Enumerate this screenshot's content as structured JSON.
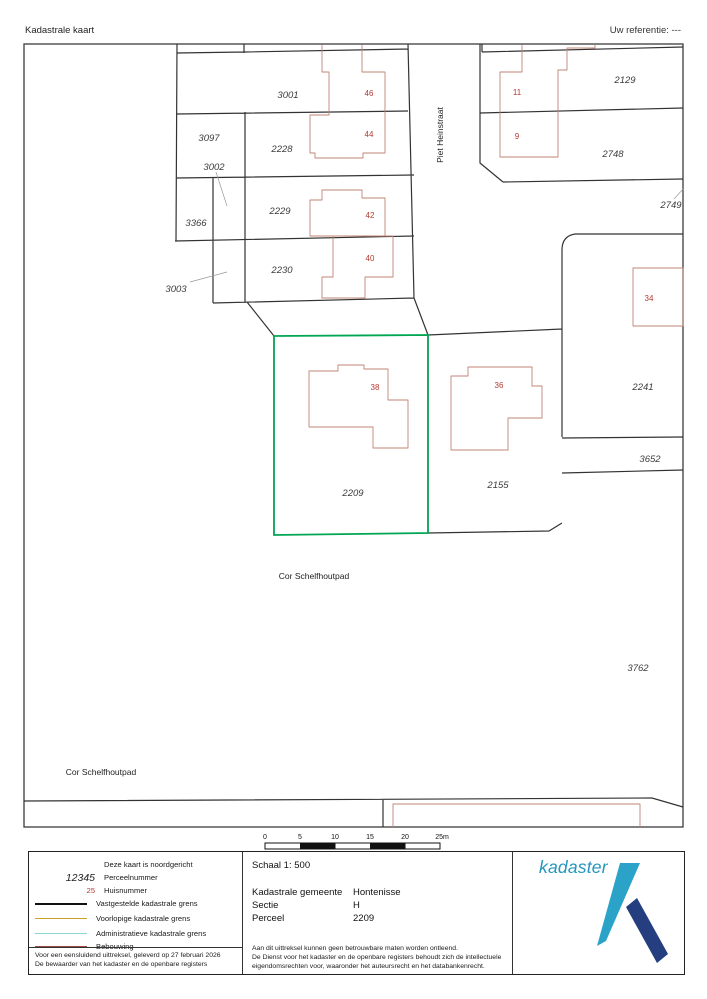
{
  "header": {
    "title": "Kadastrale kaart",
    "reference": "Uw referentie: ---"
  },
  "map": {
    "parcels": [
      "3001",
      "3097",
      "2228",
      "3002",
      "2229",
      "3366",
      "2230",
      "3003",
      "2129",
      "2748",
      "2749",
      "2241",
      "3652",
      "2209",
      "2155",
      "3762"
    ],
    "house_numbers": [
      "46",
      "44",
      "42",
      "40",
      "11",
      "9",
      "34",
      "38",
      "36"
    ],
    "streets": [
      "Piet Heinstraat",
      "Cor Schelfhoutpad",
      "Cor Schelfhoutpad"
    ],
    "highlighted_parcel": "2209",
    "colors": {
      "highlight_green": "#00a651",
      "boundary_black": "#333333",
      "building_red": "#c08577",
      "house_number_red": "#b23a32"
    }
  },
  "scale_bar": {
    "ticks": [
      "0",
      "5",
      "10",
      "15",
      "20",
      "25m"
    ]
  },
  "legend": {
    "rows": [
      {
        "symbol": "",
        "label": "Deze kaart is noordgericht"
      },
      {
        "symbol": "12345",
        "label": "Perceelnummer"
      },
      {
        "symbol": "25",
        "label": "Huisnummer"
      },
      {
        "symbol": "",
        "label": "Vastgestelde kadastrale grens"
      },
      {
        "symbol": "",
        "label": "Voorlopige kadastrale grens"
      },
      {
        "symbol": "",
        "label": "Administratieve kadastrale grens"
      },
      {
        "symbol": "",
        "label": "Bebouwing"
      }
    ],
    "line_colors": {
      "vastgestelde": "#111111",
      "voorlopige": "#c9a227",
      "administratieve": "#8fd8d2",
      "bebouwing": "#9c4a42"
    },
    "footer_lines": [
      "Voor een eensluidend uittreksel, geleverd op 27 februari 2026",
      "De bewaarder van het kadaster en de openbare registers"
    ]
  },
  "info": {
    "scale": "Schaal 1: 500",
    "rows": [
      {
        "label": "Kadastrale gemeente",
        "value": "Hontenisse"
      },
      {
        "label": "Sectie",
        "value": "H"
      },
      {
        "label": "Perceel",
        "value": "2209"
      }
    ],
    "disclaimer_lines": [
      "Aan dit uittreksel kunnen geen betrouwbare maten worden ontleend.",
      "De Dienst voor het kadaster en de openbare registers behoudt zich de intellectuele",
      "eigendomsrechten voor, waaronder het auteursrecht en het databankenrecht."
    ]
  },
  "logo": {
    "wordmark": "kadaster",
    "colors": {
      "word": "#2496bc",
      "light_blue": "#2ba3c8",
      "dark_blue": "#253e80"
    }
  }
}
